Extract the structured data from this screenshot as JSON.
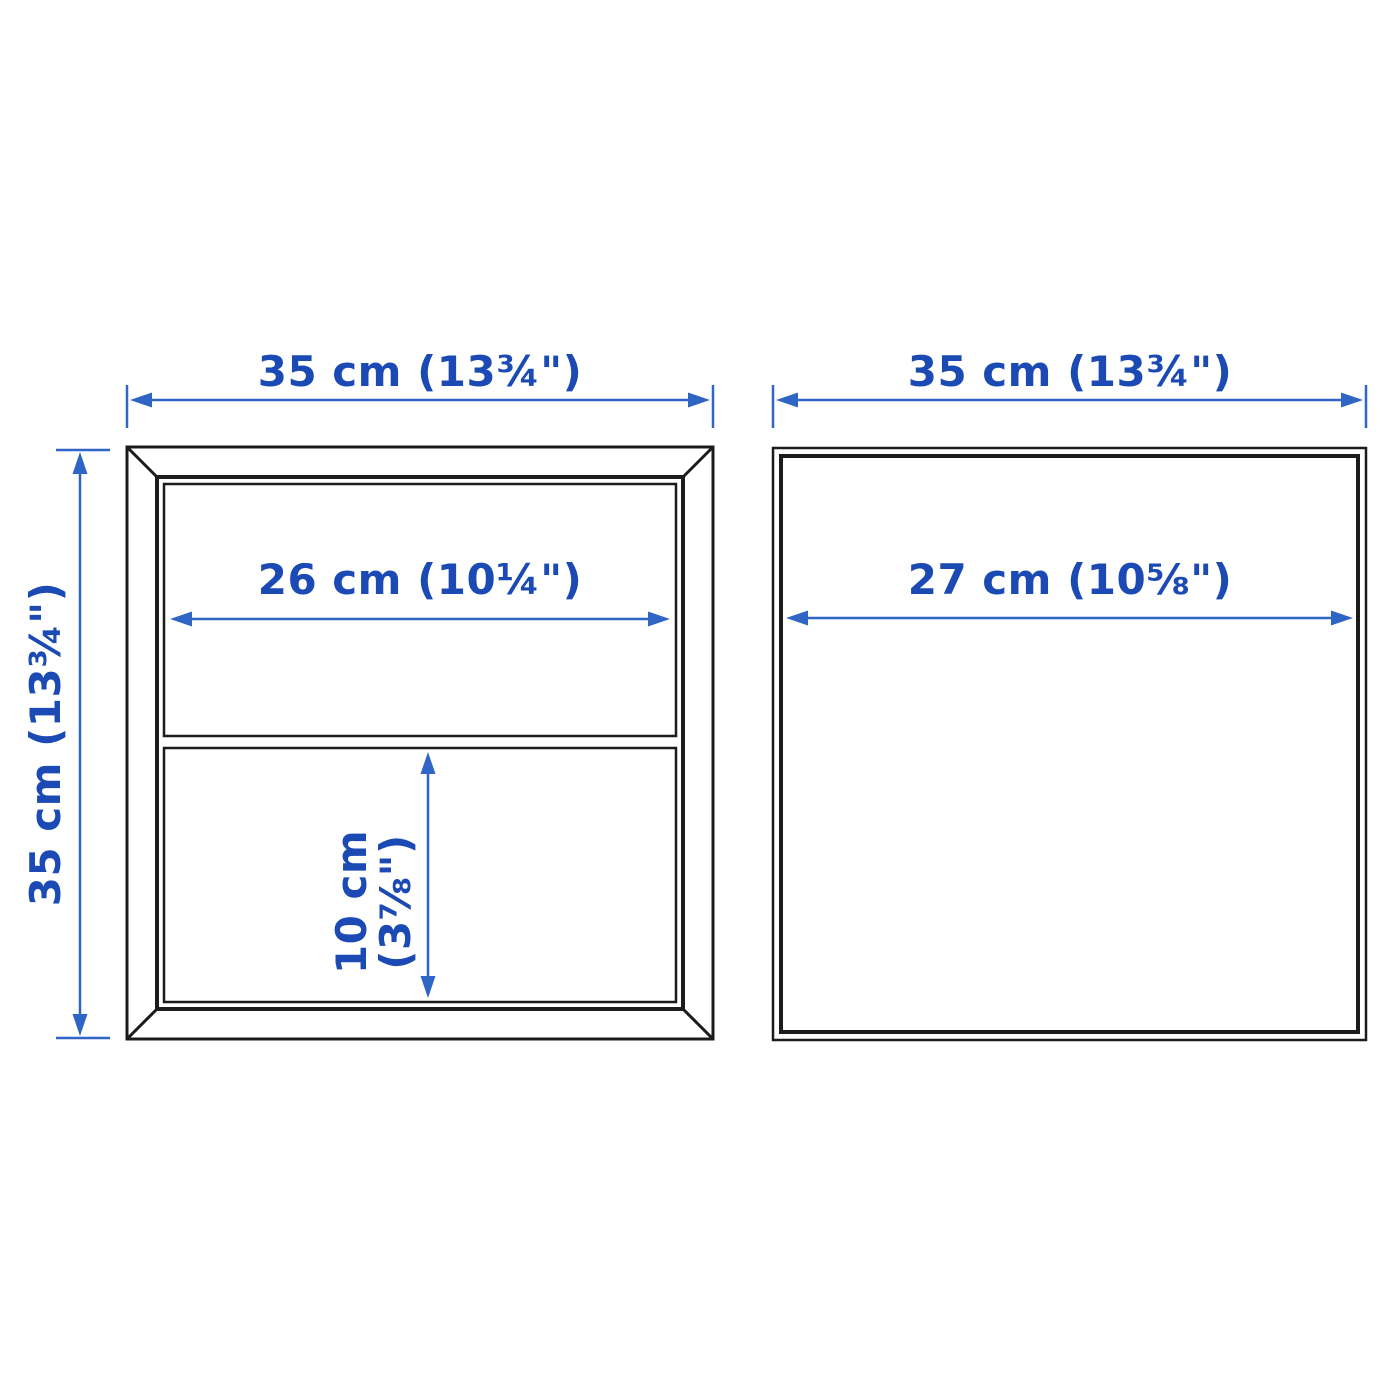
{
  "page": {
    "background": "#ffffff",
    "description_name": "cube-storage-dimension-diagram"
  },
  "colors": {
    "outline_black": "#1c1c1c",
    "dimension_text_blue": "#1b4ab4",
    "dimension_line_blue": "#2f66c6"
  },
  "diagram": {
    "front_view": {
      "overall_width": "35 cm (13¾\")",
      "overall_height": "35 cm (13¾\")",
      "inner_width": "26 cm (10¼\")",
      "inner_height_line1": "10 cm",
      "inner_height_line2": "(3⅞\")"
    },
    "side_view": {
      "overall_depth": "35 cm (13¾\")",
      "inner_depth": "27 cm (10⅝\")"
    }
  }
}
